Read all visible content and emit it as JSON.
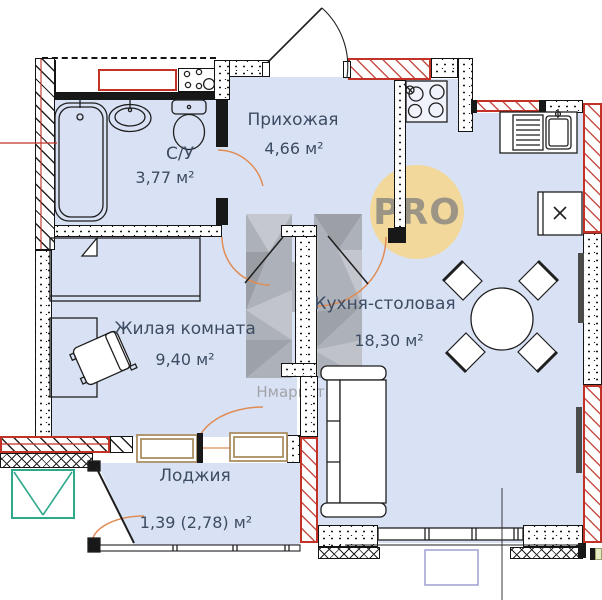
{
  "rooms": [
    {
      "name": "С/У",
      "area": "3,77 м²"
    },
    {
      "name": "Прихожая",
      "area": "4,66 м²"
    },
    {
      "name": "Кухня-столовая",
      "area": "18,30 м²"
    },
    {
      "name": "Жилая комната",
      "area": "9,40 м²"
    },
    {
      "name": "Лоджия",
      "area": "1,39 (2,78) м²"
    }
  ],
  "watermark": {
    "badge": "PRO",
    "brand": "Нмаркет.ПРО"
  },
  "colors": {
    "floor": "#d9e2f5",
    "wall": "#141414",
    "duct_red": "#c23227",
    "door_arc_orange": "#e08c55",
    "shaft_teal": "#2fa98c",
    "ac_basket_purple": "#9a9ace",
    "badge_yellow": "#f3d793",
    "watermark_gray": "#b3b2b1",
    "frame_tan": "#a98e63"
  }
}
